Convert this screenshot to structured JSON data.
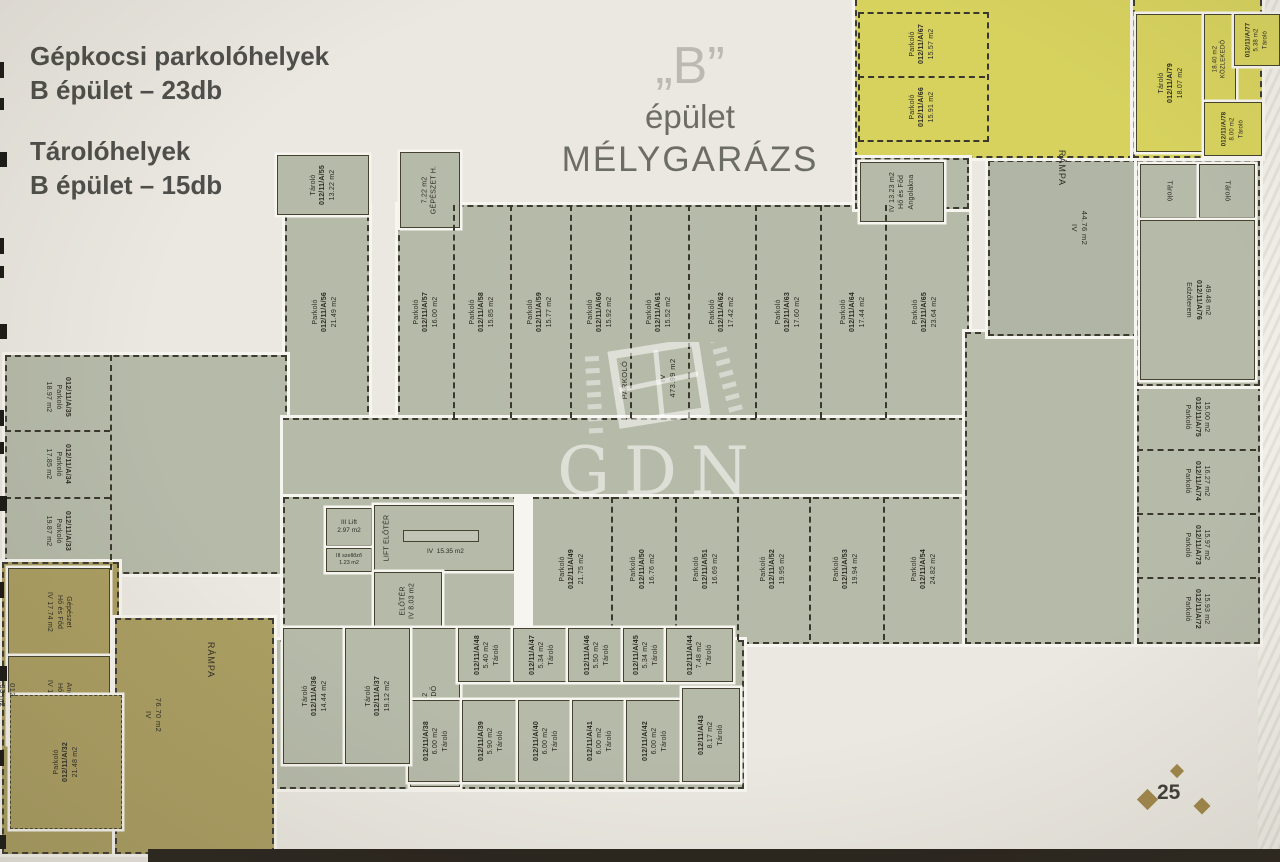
{
  "header": {
    "line1": "Gépkocsi parkolóhelyek",
    "line2": "B épület – 23db",
    "line3": "Tárolóhelyek",
    "line4": "B épület – 15db"
  },
  "title": {
    "quote": "„B”",
    "sub": "épület",
    "main": "MÉLYGARÁZS"
  },
  "watermark": {
    "text": "GDN"
  },
  "page": {
    "number": "25"
  },
  "colors": {
    "floor": "#b6baa9",
    "ramp": "#b1b5a6",
    "yellow": "#d7d25e",
    "brown": "#ab9e62",
    "wall": "#3e3c31",
    "page": "#ebe8e1"
  },
  "plan": {
    "stall_word": "Parkoló",
    "storage_word": "Tároló",
    "rows": {
      "top": [
        {
          "id": "012/11/A/56",
          "area": "21.49 m2"
        },
        {
          "id": "012/11/A/57",
          "area": "16.00 m2"
        },
        {
          "id": "012/11/A/58",
          "area": "15.85 m2"
        },
        {
          "id": "012/11/A/59",
          "area": "15.77 m2"
        },
        {
          "id": "012/11/A/60",
          "area": "15.92 m2"
        },
        {
          "id": "012/11/A/61",
          "area": "15.52 m2"
        },
        {
          "id": "012/11/A/62",
          "area": "17.42 m2"
        },
        {
          "id": "012/11/A/63",
          "area": "17.60 m2"
        },
        {
          "id": "012/11/A/64",
          "area": "17.44 m2"
        },
        {
          "id": "012/11/A/65",
          "area": "23.64 m2"
        }
      ],
      "middle": [
        {
          "id": "012/11/A/49",
          "area": "21.75 m2"
        },
        {
          "id": "012/11/A/50",
          "area": "16.76 m2"
        },
        {
          "id": "012/11/A/51",
          "area": "16.69 m2"
        },
        {
          "id": "012/11/A/52",
          "area": "19.95 m2"
        },
        {
          "id": "012/11/A/53",
          "area": "19.94 m2"
        },
        {
          "id": "012/11/A/54",
          "area": "24.82 m2"
        }
      ],
      "left": [
        {
          "id": "012/11/A/35",
          "area": "18.97 m2"
        },
        {
          "id": "012/11/A/34",
          "area": "17.85 m2"
        },
        {
          "id": "012/11/A/33",
          "area": "19.87 m2"
        }
      ],
      "right": [
        {
          "id": "012/11/A/75",
          "area": "15.00 m2"
        },
        {
          "id": "012/11/A/74",
          "area": "16.27 m2"
        },
        {
          "id": "012/11/A/73",
          "area": "15.97 m2"
        },
        {
          "id": "012/11/A/72",
          "area": "15.93 m2"
        }
      ],
      "yellow": [
        {
          "id": "012/11/A/67",
          "area": "15.57 m2"
        },
        {
          "id": "012/11/A/66",
          "area": "15.91 m2"
        }
      ]
    },
    "storage_upper": [
      {
        "id": "012/11/A/48",
        "area": "5.40 m2"
      },
      {
        "id": "012/11/A/47",
        "area": "5.34 m2"
      },
      {
        "id": "012/11/A/46",
        "area": "5.50 m2"
      },
      {
        "id": "012/11/A/45",
        "area": "5.34 m2"
      },
      {
        "id": "012/11/A/44",
        "area": "7.48 m2"
      }
    ],
    "storage_lower": [
      {
        "id": "012/11/A/38",
        "area": "6.00 m2"
      },
      {
        "id": "012/11/A/39",
        "area": "5.90 m2"
      },
      {
        "id": "012/11/A/40",
        "area": "6.00 m2"
      },
      {
        "id": "012/11/A/41",
        "area": "6.00 m2"
      },
      {
        "id": "012/11/A/42",
        "area": "6.00 m2"
      },
      {
        "id": "012/11/A/43",
        "area": "8.17 m2"
      }
    ],
    "storage_big": [
      {
        "id": "012/11/A/36",
        "area": "14.44 m2"
      },
      {
        "id": "012/11/A/37",
        "area": "19.12 m2"
      }
    ],
    "rooms": {
      "nw_storage": {
        "id": "012/11/A/55",
        "area": "13.22 m2"
      },
      "gepeszet": {
        "area": "7.22 m2",
        "name": "GÉPÉSZET H."
      },
      "angolakna_ne": {
        "floor": "IV",
        "area": "13.23 m2",
        "name1": "Hő és Főd",
        "name2": "Angolakna"
      },
      "lift": {
        "floor": "III",
        "name": "Lift",
        "area": "2.97 m2"
      },
      "szellozo": {
        "floor": "III",
        "name": "szellőző",
        "area": "1.23 m2"
      },
      "lift_eloter": {
        "name": "LIFT ELŐTÉR",
        "floor": "IV",
        "area": "15.35 m2"
      },
      "eloter": {
        "name": "ELŐTÉR",
        "floor": "IV",
        "area": "8.03 m2"
      },
      "kozlekedo": {
        "name": "KÖZLEKEDŐ",
        "floor": "IV",
        "area": "19.42 m2"
      },
      "parkolo_main": {
        "name": "PARKOLÓ",
        "floor": "IV",
        "area": "473.99 m2"
      },
      "ramp_right": {
        "name": "RÁMPA",
        "floor": "IV",
        "area": "44.76 m2"
      },
      "ramp_left": {
        "name": "RÁMPA",
        "floor": "IV",
        "area": "76.70 m2"
      },
      "ho_gepeszet": {
        "floor": "IV",
        "area": "17.74 m2",
        "name1": "Hő és Főd",
        "name2": "Gépészet"
      },
      "ho_angolakna": {
        "floor": "IV",
        "area": "13.99 m2",
        "name1": "Hő és Főd",
        "name2": "Angolakna"
      },
      "sw_parking": {
        "id": "012/11/A/32",
        "area": "21.48 m2"
      },
      "edge_stall": {
        "id": "012",
        "area": "19.33 m2"
      },
      "edzoterem": {
        "name": "Edzőterem",
        "id": "012/11/A/76",
        "area": "49.48 m2"
      },
      "y_big": {
        "id": "012/11/A/79",
        "area": "18.07 m2"
      },
      "y_kozlekedo": {
        "name": "KÖZLEKEDŐ",
        "area": "18.40 m2"
      },
      "y_st1": {
        "id": "012/11/A/77",
        "area": "5.38 m2"
      },
      "y_st2": {
        "id": "012/11/A/78",
        "area": "8.00 m2"
      }
    }
  }
}
